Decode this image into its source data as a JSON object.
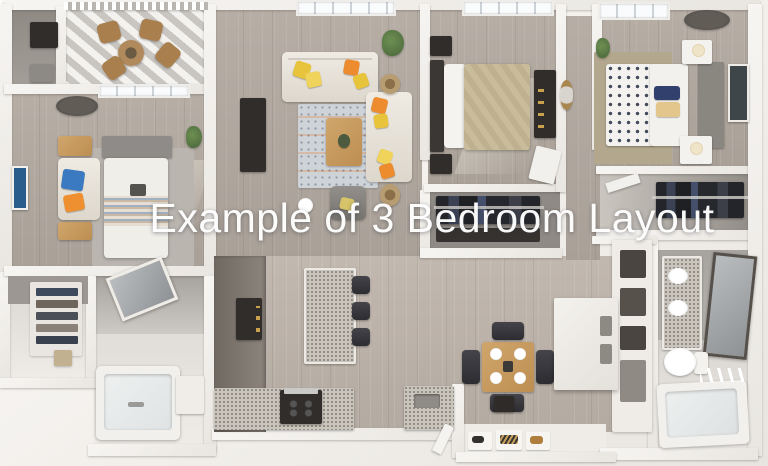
{
  "overlay": {
    "title": "Example of 3 Bedroom Layout",
    "text_color": "#ffffff"
  },
  "palette": {
    "background": "#f2efeb",
    "wall_white": "#f3f1ed",
    "floor_wood": "#b2a9a0",
    "bathroom_tile": "#a7a39f",
    "accent_yellow": "#e8c43c",
    "accent_orange": "#ec8c2e",
    "accent_blue": "#3b79c0",
    "furniture_wood": "#c79a5e",
    "furniture_dark": "#302d2a",
    "granite": "#c9c4bc",
    "bedding_tan": "#c9bc9b"
  },
  "scene": {
    "type": "3d-floor-plan-render",
    "rooms": [
      {
        "id": "storage-closet",
        "items": [
          "shelving-unit",
          "utility-box"
        ]
      },
      {
        "id": "patio",
        "items": [
          "striped-awning-floor",
          "bistro-table",
          "patio-chairs",
          "railing"
        ]
      },
      {
        "id": "bedroom-1",
        "items": [
          "bed",
          "gray-headboard",
          "striped-duvet",
          "bench-with-blue-orange-pillows",
          "wood-nightstands",
          "blue-wall-art",
          "ceiling-fan",
          "plant",
          "area-rug",
          "window"
        ]
      },
      {
        "id": "walk-in-closet-1",
        "items": [
          "folded-clothes-shelves",
          "basket"
        ]
      },
      {
        "id": "bathroom-1",
        "items": [
          "bathtub",
          "vanity-sink",
          "tilted-mirror"
        ]
      },
      {
        "id": "living-room",
        "items": [
          "sofa",
          "loveseat",
          "gray-armchair",
          "yellow-pillows",
          "orange-pillows",
          "patterned-rug",
          "wood-coffee-table",
          "tv-console",
          "wicker-side-tables",
          "plant",
          "floor-lamp",
          "window"
        ]
      },
      {
        "id": "bedroom-2",
        "items": [
          "bed-tan-duvet",
          "dark-headboard",
          "dark-nightstands",
          "dark-dresser",
          "white-desk",
          "window",
          "sunlight-patch"
        ]
      },
      {
        "id": "closet-2",
        "items": [
          "hanging-clothes"
        ]
      },
      {
        "id": "hallway",
        "items": [
          "round-gold-mirror"
        ]
      },
      {
        "id": "bedroom-3",
        "items": [
          "polka-dot-bed",
          "gray-headboard",
          "white-nightstands",
          "lamps",
          "tan-rug",
          "wall-art",
          "ceiling-fan",
          "plant",
          "window"
        ]
      },
      {
        "id": "closet-3",
        "items": [
          "hanging-clothes"
        ]
      },
      {
        "id": "linen-shelves",
        "items": [
          "cubby-shelves"
        ]
      },
      {
        "id": "bathroom-2",
        "items": [
          "granite-double-vanity",
          "framed-mirror",
          "toilet",
          "bathtub"
        ]
      },
      {
        "id": "kitchen",
        "items": [
          "dark-cabinets",
          "refrigerator",
          "granite-island",
          "bar-stools",
          "range-stove",
          "sink-counter"
        ]
      },
      {
        "id": "dining-area",
        "items": [
          "square-wood-table",
          "place-settings",
          "dark-chairs"
        ]
      },
      {
        "id": "laundry-cabinet",
        "items": [
          "white-cabinet-drawers"
        ]
      },
      {
        "id": "entry",
        "items": [
          "doormats",
          "shoes",
          "thermostat-panel",
          "door-leaf"
        ]
      }
    ]
  }
}
